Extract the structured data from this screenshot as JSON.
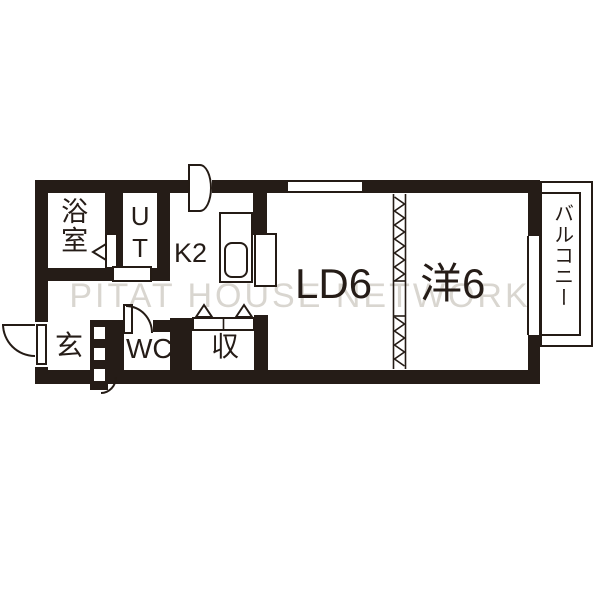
{
  "watermark": "PITAT HOUSE NETWORK",
  "rooms": {
    "bathroom": "浴室",
    "utility": "UT",
    "kitchen": "K2",
    "living_dining": "LD6",
    "western_room": "洋6",
    "entrance": "玄",
    "toilet": "WC",
    "storage": "収",
    "balcony": "バルコニー"
  },
  "colors": {
    "wall": "#251c17",
    "line": "#241b15",
    "watermark": "#d9d6d0",
    "background": "#ffffff"
  }
}
